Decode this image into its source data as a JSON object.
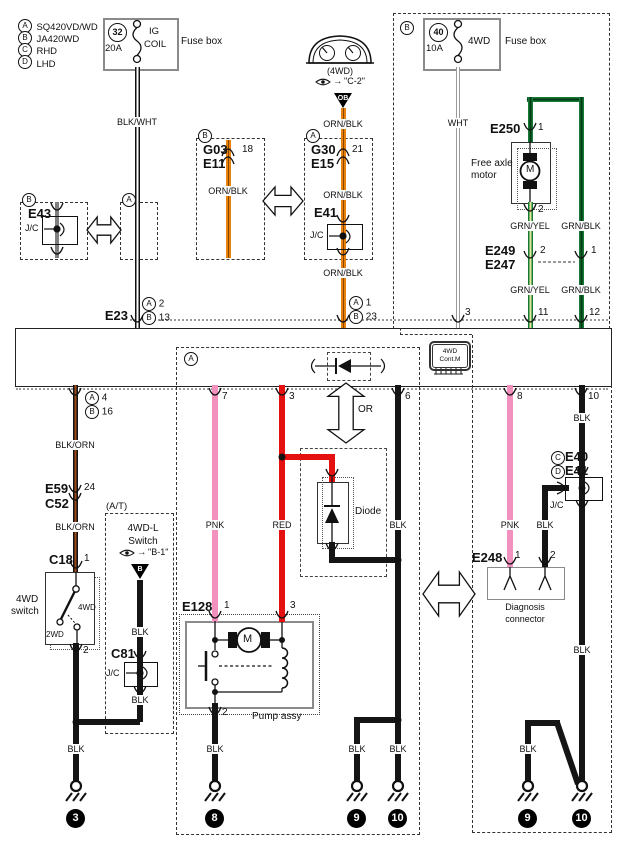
{
  "legend": {
    "items": [
      {
        "mark": "A",
        "label": "SQ420VD/WD"
      },
      {
        "mark": "B",
        "label": "JA420WD"
      },
      {
        "mark": "C",
        "label": "RHD"
      },
      {
        "mark": "D",
        "label": "LHD"
      }
    ]
  },
  "marks": {
    "a": "A",
    "b": "B",
    "c": "C",
    "d": "D"
  },
  "fuses": {
    "left": {
      "num": "32",
      "amp": "20A",
      "name_l1": "IG",
      "name_l2": "COIL",
      "box": "Fuse box"
    },
    "right": {
      "num": "40",
      "amp": "10A",
      "name": "4WD",
      "box": "Fuse box"
    }
  },
  "wires": {
    "blk_wht": "BLK/WHT",
    "orn_blk": "ORN/BLK",
    "wht": "WHT",
    "grn_yel": "GRN/YEL",
    "grn_blk": "GRN/BLK",
    "blk_orn": "BLK/ORN",
    "pnk": "PNK",
    "red": "RED",
    "blk": "BLK"
  },
  "sections": {
    "at": "(A/T)"
  },
  "connectors": {
    "e43": {
      "name": "E43",
      "jc": "J/C"
    },
    "g03": {
      "l1": "G03",
      "l2": "E11",
      "pin": "18"
    },
    "g30": {
      "l1": "G30",
      "l2": "E15",
      "pin": "21"
    },
    "e41": {
      "name": "E41",
      "jc": "J/C"
    },
    "e23": {
      "name": "E23",
      "pin_a": "2",
      "pin_b": "13"
    },
    "orn_entry": {
      "pin_a": "1",
      "pin_b": "23"
    },
    "wht_entry": {
      "pin": "3"
    },
    "e250": {
      "name": "E250",
      "pin_top": "1",
      "pin_bot": "2"
    },
    "e249": {
      "l1": "E249",
      "l2": "E247",
      "pin_l": "2",
      "pin_r": "1",
      "pin11": "11",
      "pin12": "12"
    },
    "blkorn_exit": {
      "pin_a": "4",
      "pin_b": "16"
    },
    "e59": {
      "l1": "E59",
      "l2": "C52",
      "pin": "24"
    },
    "c18": {
      "name": "C18",
      "pin1": "1",
      "pin2": "2"
    },
    "c81": {
      "name": "C81",
      "jc": "J/C"
    },
    "e128": {
      "name": "E128",
      "pin1": "1",
      "pin3": "3",
      "pin2": "2"
    },
    "e248": {
      "name": "E248",
      "pin1": "1",
      "pin2": "2"
    },
    "e40_jc": {
      "l1": "E40",
      "l2": "E41",
      "jc": "J/C"
    },
    "module_pins": {
      "pnk7": "7",
      "red3": "3",
      "blk6": "6",
      "pnk8": "8",
      "blk10": "10"
    }
  },
  "components": {
    "module_chip": {
      "l1": "4WD",
      "l2": "Cont.M"
    },
    "motor": {
      "l1": "Free axle",
      "l2": "motor",
      "m": "M"
    },
    "cluster": {
      "label": "(4WD)",
      "goto": "\"C-2\"",
      "conn": "OB",
      "arrow": "→"
    },
    "sw4wd": {
      "l1": "4WD",
      "l2": "switch",
      "on": "4WD",
      "off": "2WD"
    },
    "sw4wdl": {
      "l1": "4WD-L",
      "l2": "Switch",
      "goto": "\"B-1\"",
      "conn": "B",
      "arrow": "→"
    },
    "pump": {
      "label": "Pump assy",
      "m": "M"
    },
    "diode": {
      "label": "Diode"
    },
    "or_label": "OR",
    "diag": {
      "l1": "Diagnosis",
      "l2": "connector"
    }
  },
  "grounds": {
    "g3": "3",
    "g8": "8",
    "g9": "9",
    "g10": "10"
  },
  "colors": {
    "orange": "#E8830D",
    "green": "#157A35",
    "pink": "#F291BE",
    "red": "#E51010",
    "black": "#151515"
  }
}
